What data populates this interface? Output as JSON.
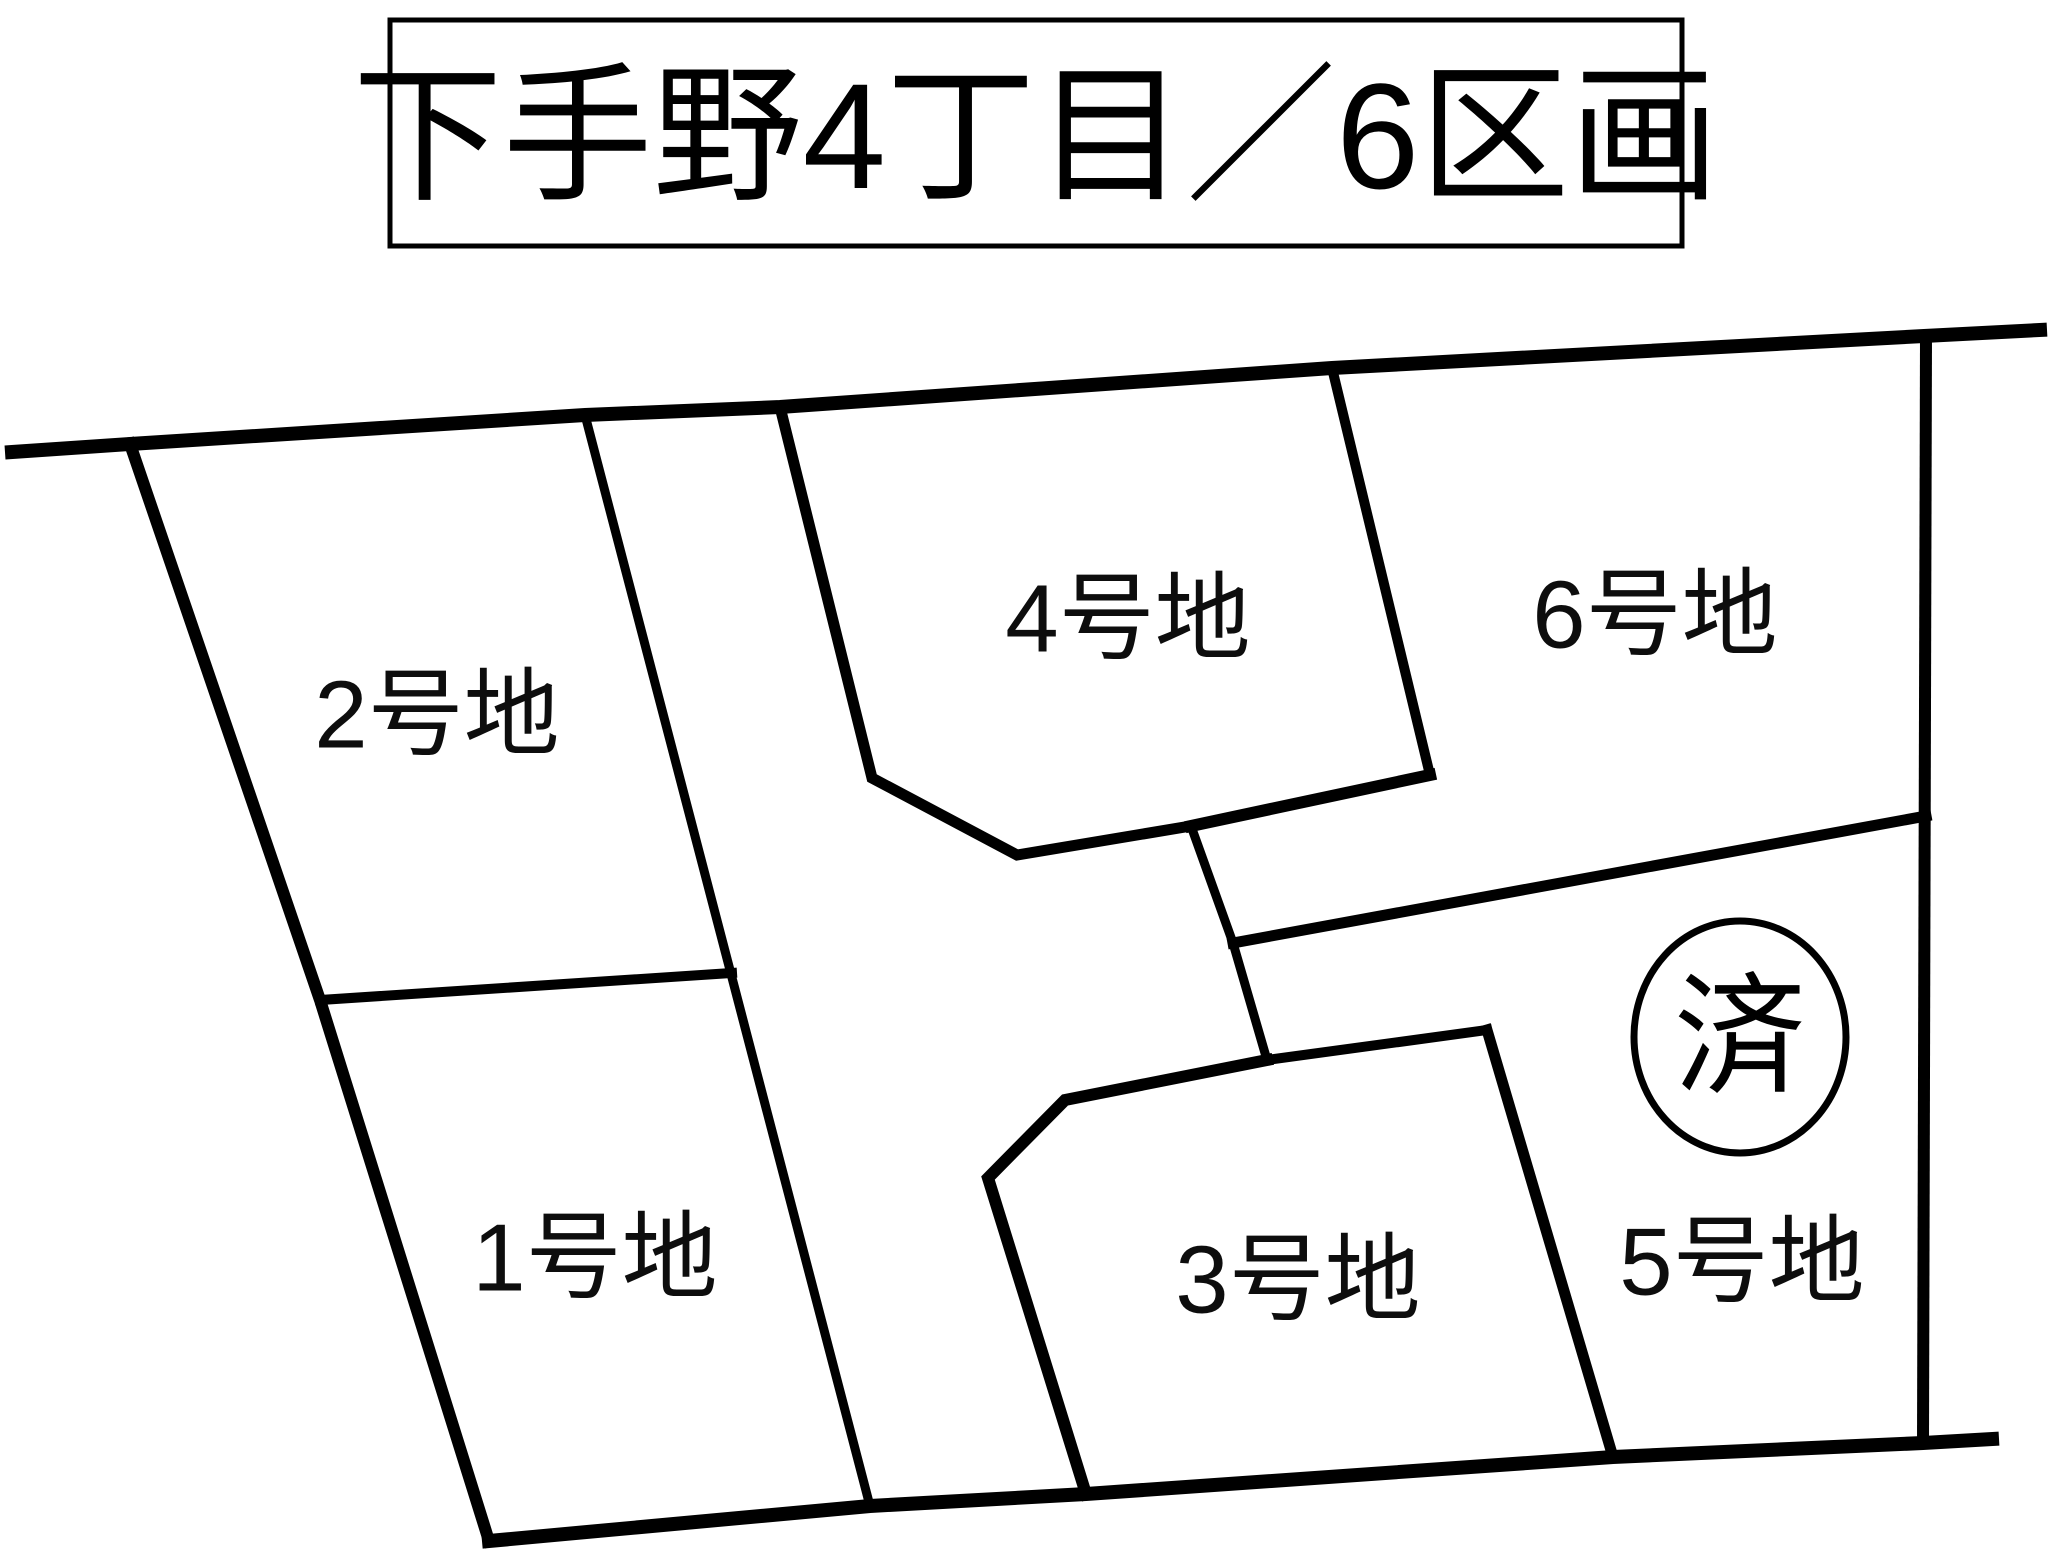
{
  "title": {
    "text": "下手野4丁目／6区画",
    "box": {
      "x": 390,
      "y": 20,
      "w": 1292,
      "h": 226,
      "border_w": 5
    },
    "font_size": 150,
    "text_x": 1036,
    "text_y": 136
  },
  "map": {
    "width": 2048,
    "height": 1560,
    "background": "#ffffff",
    "line_color": "#000000",
    "label_color": "#0d0d0d",
    "label_font_size": 96,
    "lines": [
      {
        "name": "top-road-boundary",
        "points": "12,452 130,444 585,415 780,407 1332,368 1924,336 2040,330",
        "w": 14
      },
      {
        "name": "left-outer-edge",
        "points": "130,444 320,1000 489,1541",
        "w": 12
      },
      {
        "name": "bottom-road-boundary",
        "points": "489,1541 870,1506 1086,1494 1613,1457 1923,1443 1992,1439",
        "w": 14
      },
      {
        "name": "right-outer-edge",
        "points": "1926,336 1923,1443",
        "w": 12
      },
      {
        "name": "west-road-edge",
        "points": "585,415 870,1506",
        "w": 9
      },
      {
        "name": "divider-lot1-lot2",
        "points": "320,1000 732,973",
        "w": 10
      },
      {
        "name": "lot4-west-outline",
        "points": "780,407 872,778 1017,855 1191,826",
        "w": 11
      },
      {
        "name": "divider-lot4-lot6",
        "points": "1332,368 1430,775",
        "w": 10
      },
      {
        "name": "lot6-southwest-edge",
        "points": "1430,775 1191,826",
        "w": 12
      },
      {
        "name": "road-center-segment",
        "points": "1191,826 1233,943 1267,1060",
        "w": 9
      },
      {
        "name": "divider-lot5-lot6",
        "points": "1233,943 1926,816",
        "w": 11
      },
      {
        "name": "lot3-northeast-edge",
        "points": "1267,1060 1487,1030",
        "w": 10
      },
      {
        "name": "divider-lot3-lot5",
        "points": "1487,1030 1613,1457",
        "w": 11
      },
      {
        "name": "lot3-west-outline",
        "points": "1267,1060 1065,1100 988,1178 1086,1494",
        "w": 12
      }
    ],
    "lots": [
      {
        "id": "lot-1",
        "label": "1号地",
        "x": 595,
        "y": 1258
      },
      {
        "id": "lot-2",
        "label": "2号地",
        "x": 437,
        "y": 715
      },
      {
        "id": "lot-3",
        "label": "3号地",
        "x": 1298,
        "y": 1280
      },
      {
        "id": "lot-4",
        "label": "4号地",
        "x": 1128,
        "y": 619
      },
      {
        "id": "lot-5",
        "label": "5号地",
        "x": 1742,
        "y": 1262
      },
      {
        "id": "lot-6",
        "label": "6号地",
        "x": 1655,
        "y": 615
      }
    ],
    "sold_mark": {
      "text": "済",
      "cx": 1740,
      "cy": 1037,
      "rx": 106,
      "ry": 116,
      "ring_w": 7,
      "font_size": 132
    }
  }
}
